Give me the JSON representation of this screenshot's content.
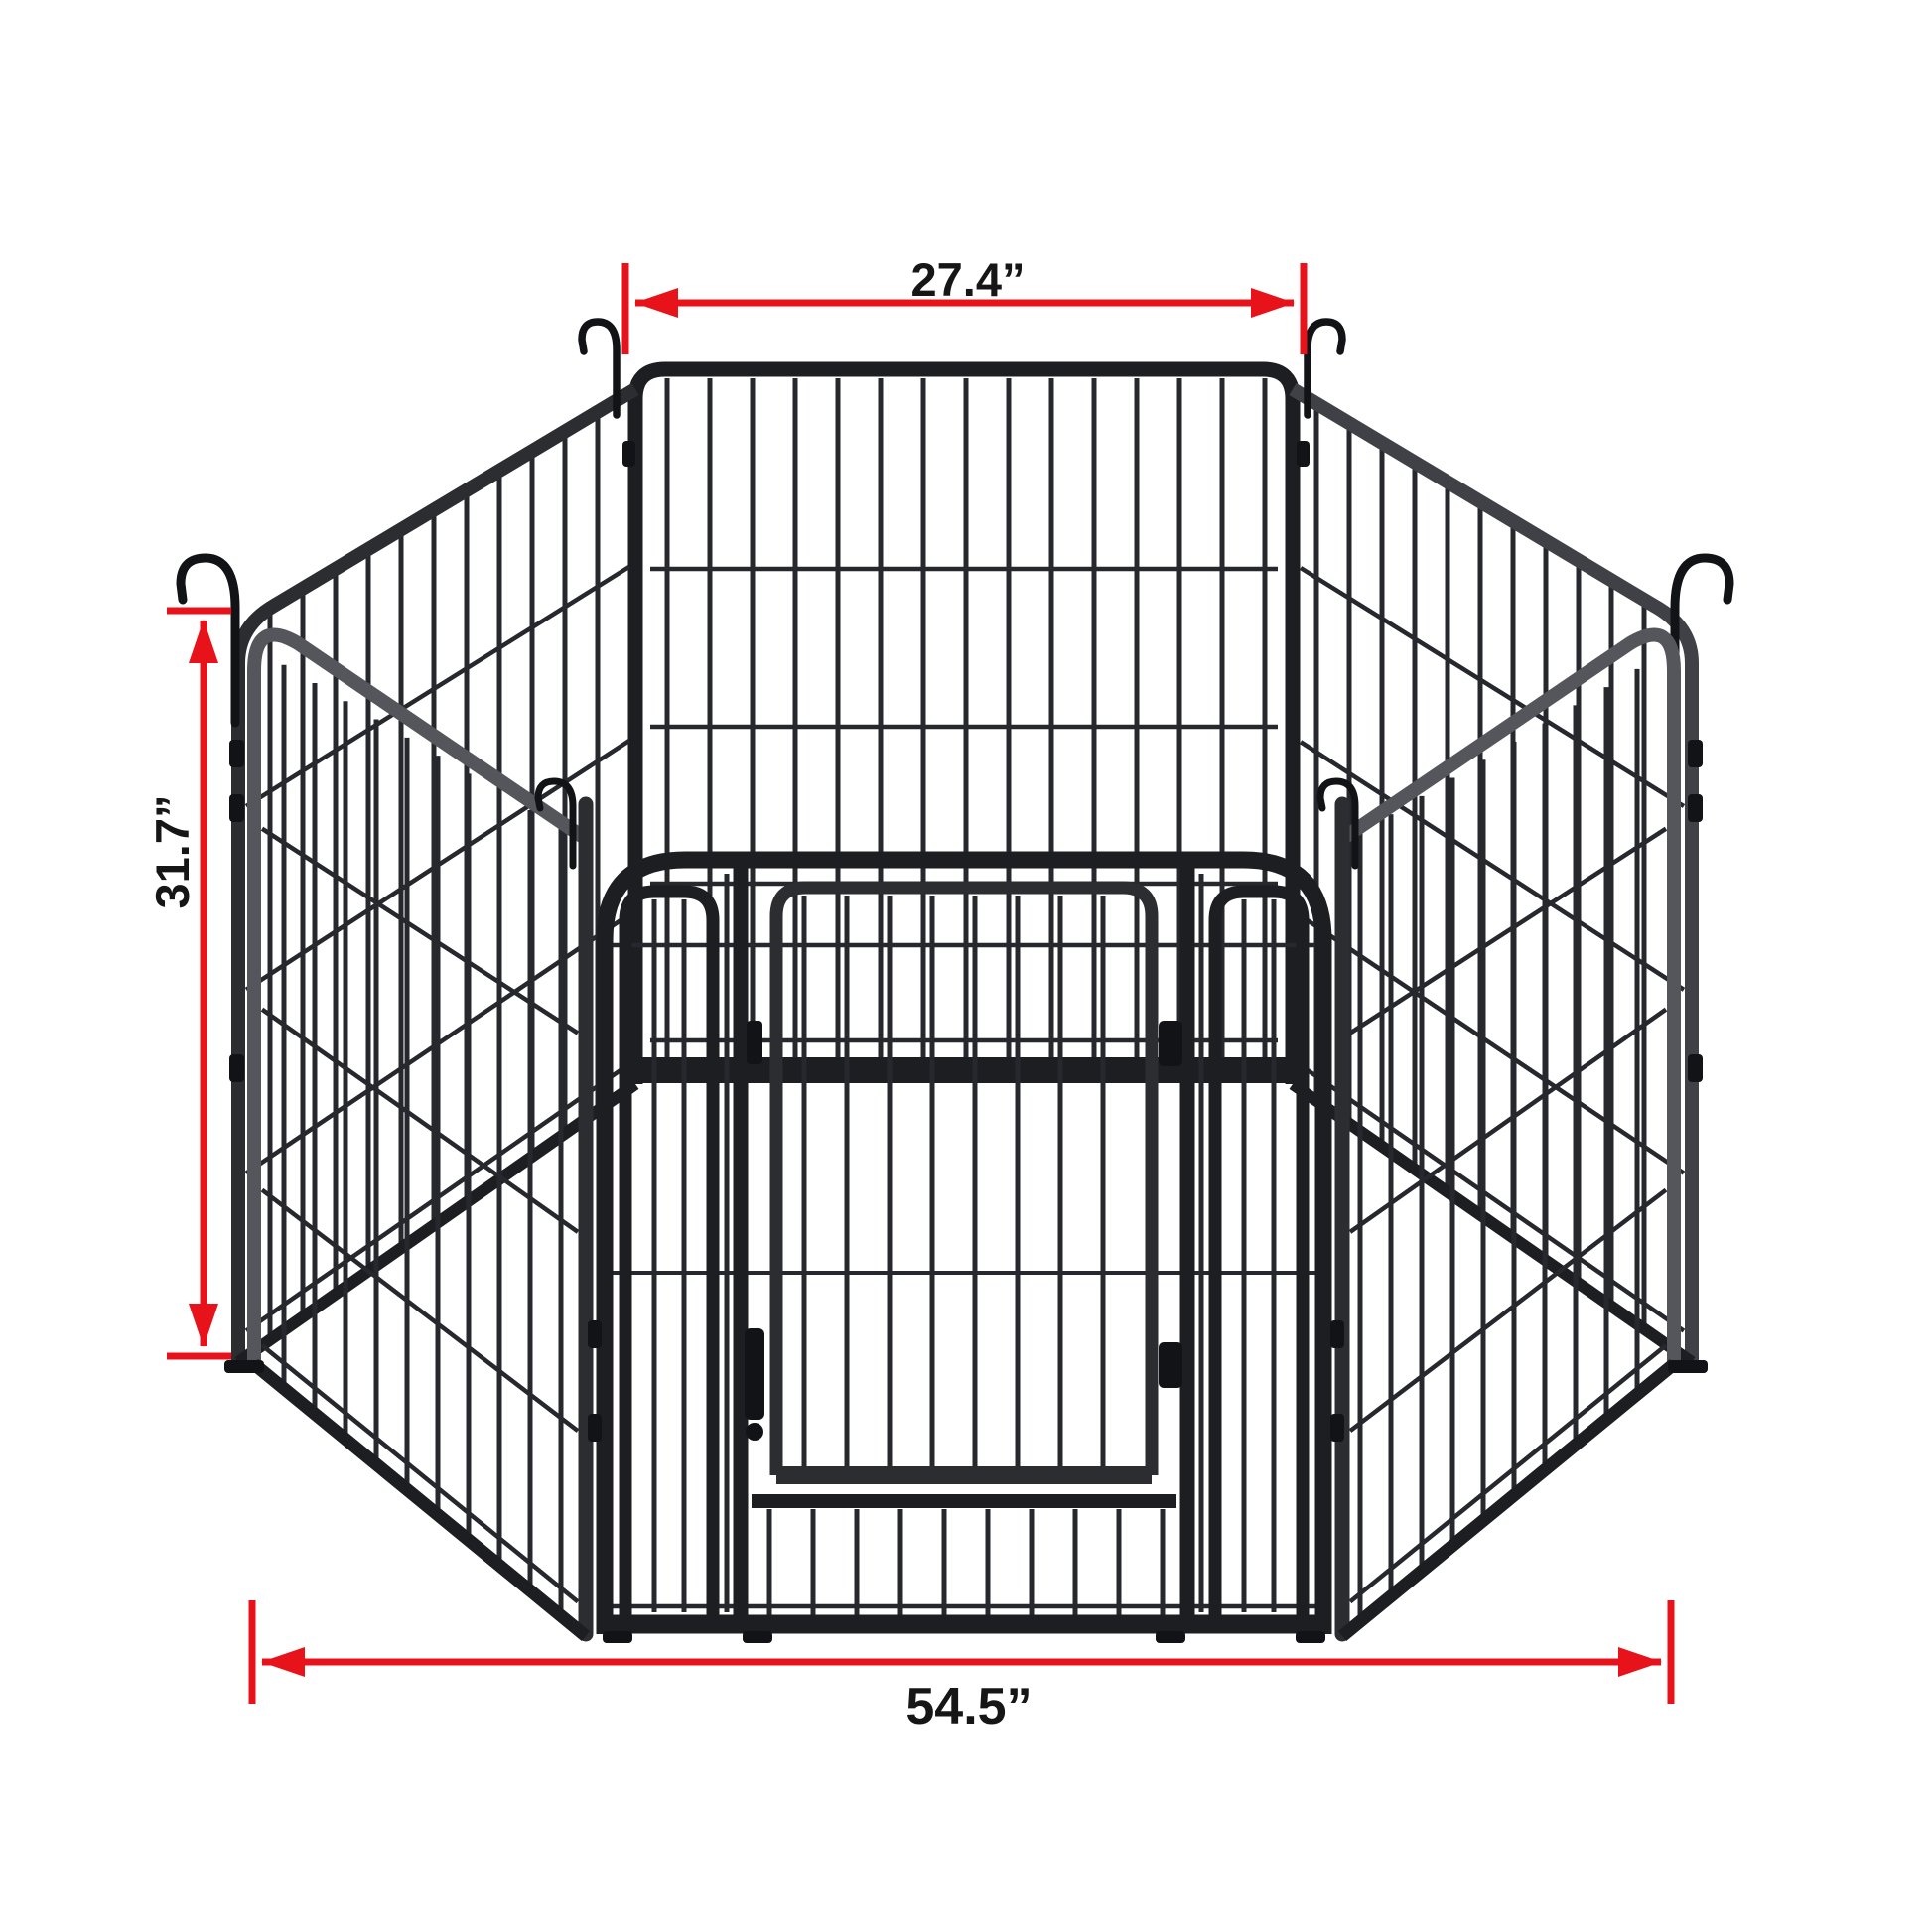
{
  "image": {
    "alt": "Six-panel black metal dog playpen arranged as a hexagon with an arched front gate, shown on a white background with red dimension callouts",
    "background": "#ffffff"
  },
  "dimensions": {
    "top": {
      "label": "27.4”",
      "orientation": "horizontal",
      "measures": "single panel width"
    },
    "left": {
      "label": "31.7”",
      "orientation": "vertical",
      "measures": "panel height"
    },
    "bottom": {
      "label": "54.5”",
      "orientation": "horizontal",
      "measures": "overall width"
    }
  },
  "colors": {
    "background": "#ffffff",
    "dimension_red": "#e8121a",
    "label_ink": "#161616",
    "frame_dark": "#1d1e22",
    "frame_mid": "#2b2d31",
    "rail_gray": "#54565c",
    "rail_gray2": "#3f4146",
    "wire": "#26282d",
    "fitting": "#121316"
  },
  "parts": {
    "panel_count_label": "6 panels",
    "gate": "front gate with swing door, latch on left, hinges on right",
    "hooks": "corner hanger hooks"
  }
}
